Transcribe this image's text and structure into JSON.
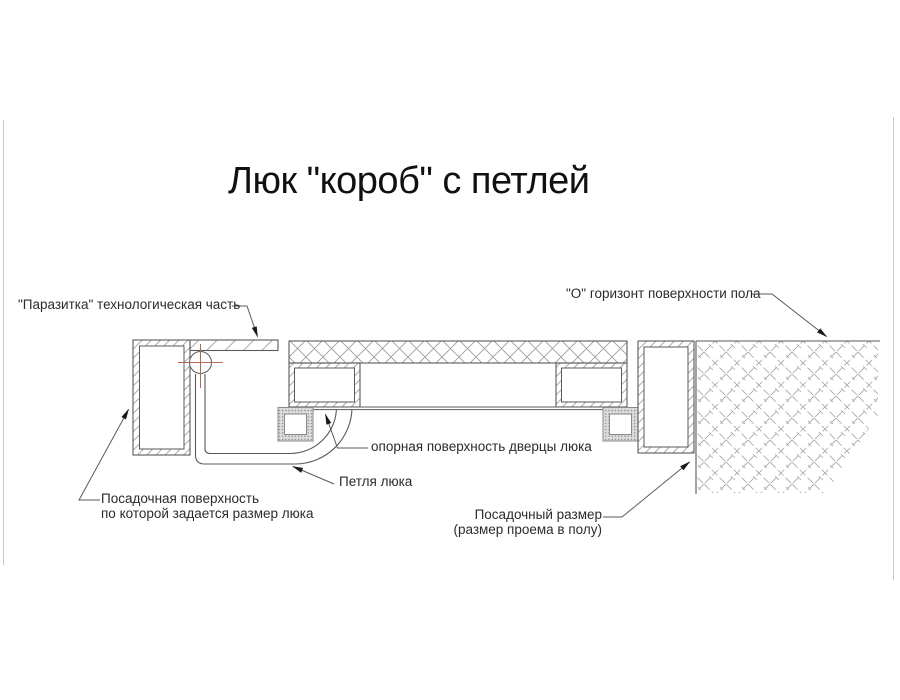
{
  "title": "Люк \"короб\" с петлей",
  "labels": {
    "parasitka": "\"Паразитка\" технологическая часть",
    "floor_horizon": "\"О\" горизонт поверхности пола",
    "door_bearing": "опорная поверхность дверцы люка",
    "hinge": "Петля люка",
    "seating_surface_line1": "Посадочная поверхность",
    "seating_surface_line2": "по которой задается размер люка",
    "seating_size_line1": "Посадочный размер",
    "seating_size_line2": "(размер проема в полу)"
  },
  "colors": {
    "line": "#5a5a5a",
    "hatch": "#9c9c9c",
    "centerline": "#b4685c",
    "text": "#2b2b2b",
    "title": "#111111",
    "edge": "#c9c9c9",
    "arrow": "#1a1a1a"
  }
}
